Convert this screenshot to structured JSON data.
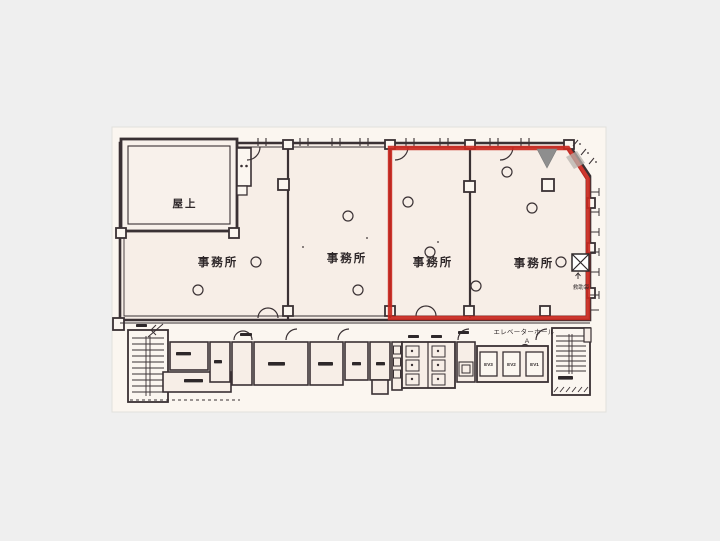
{
  "image": {
    "background_color": "#efefef",
    "paper_color": "#fbf6f0",
    "room_color": "#f7eee7",
    "line_color": "#3a3134",
    "red_outline_color": "#c9281f",
    "triangle_color": "#8e8e8e"
  },
  "plan": {
    "roof_label": "屋上",
    "office_labels": [
      "事務所",
      "事務所",
      "事務所",
      "事務所"
    ],
    "elevator_hall": {
      "line1": "エレベーターホール",
      "line2": "A"
    },
    "elevator_labels": [
      "EV3",
      "EV2",
      "EV1"
    ],
    "rescue_bag_label": "救助袋"
  }
}
